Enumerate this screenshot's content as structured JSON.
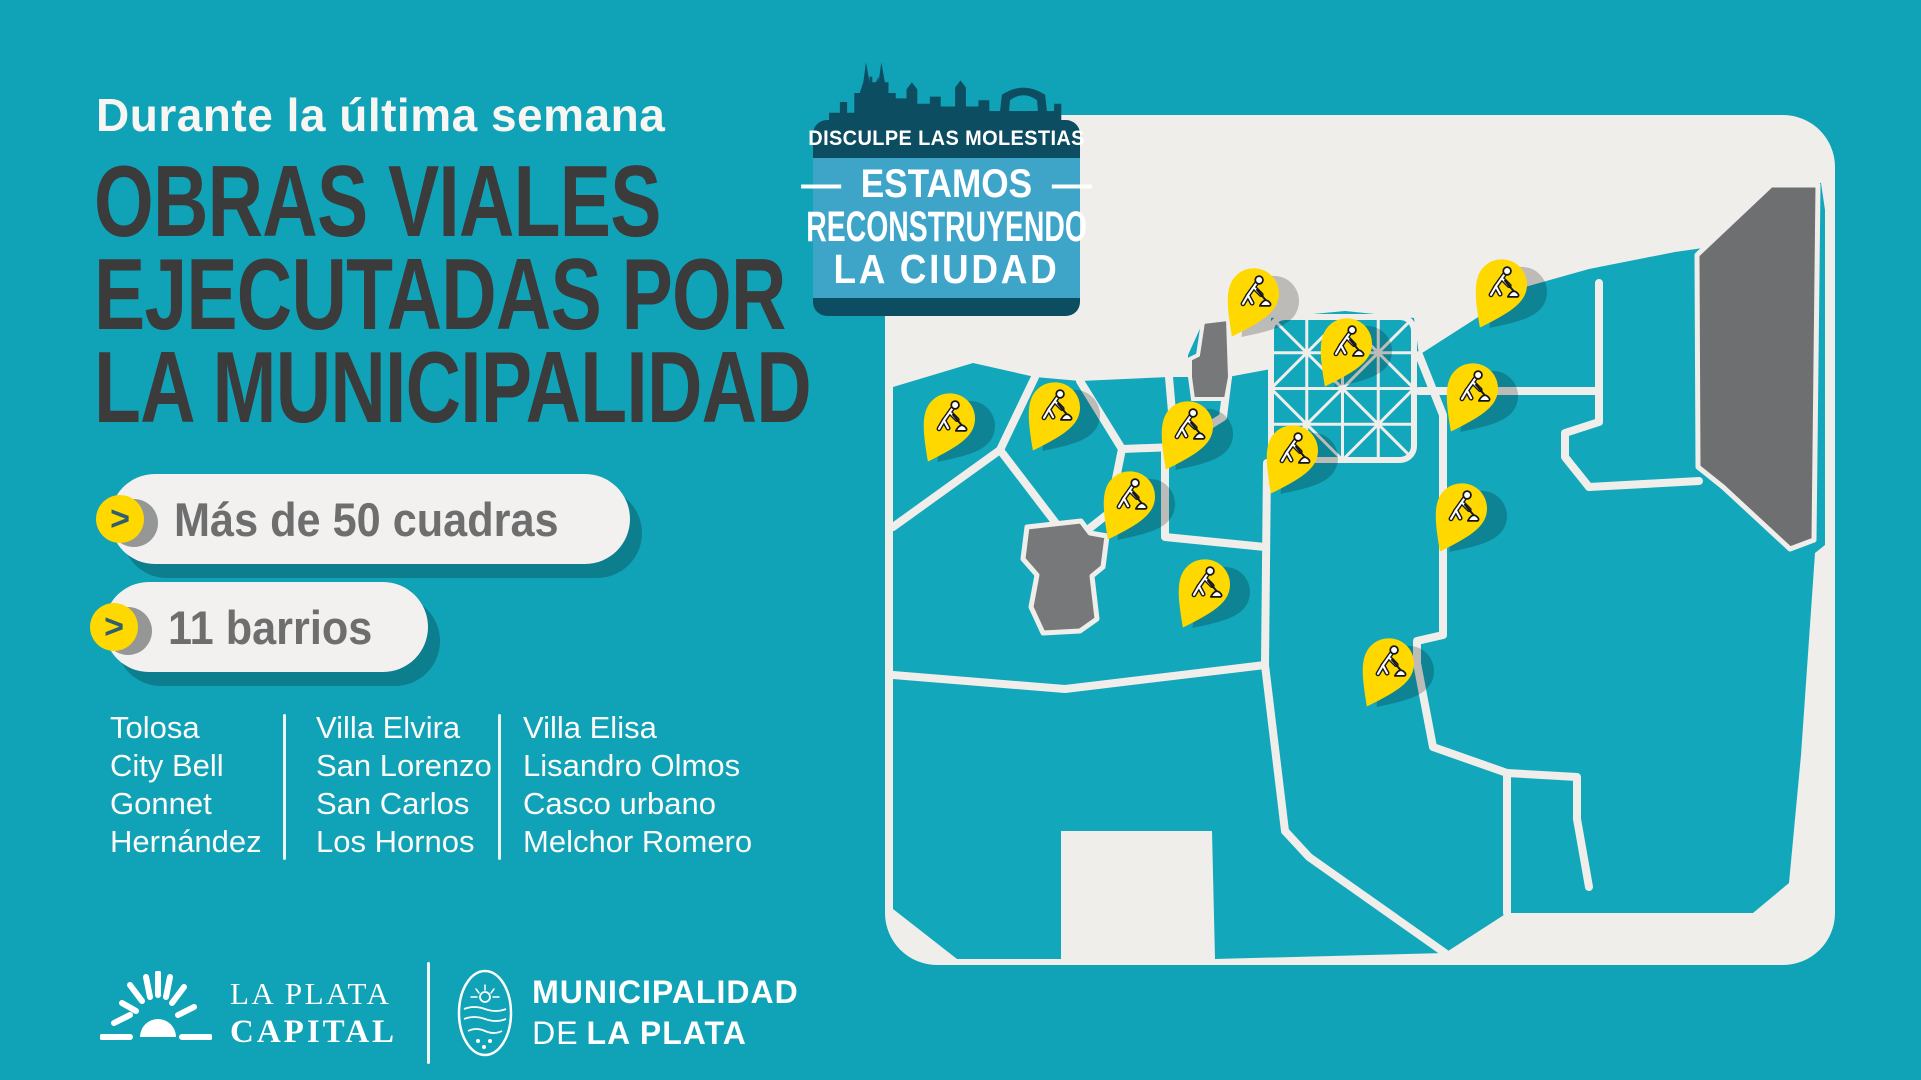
{
  "header": {
    "kicker": "Durante la última semana",
    "title_lines": [
      "OBRAS VIALES",
      "EJECUTADAS POR",
      "LA MUNICIPALIDAD"
    ]
  },
  "stats": [
    {
      "label": "Más de 50 cuadras"
    },
    {
      "label": "11 barrios"
    }
  ],
  "stats_chevron": ">",
  "neighborhoods": {
    "columns": [
      [
        "Tolosa",
        "City Bell",
        "Gonnet",
        "Hernández"
      ],
      [
        "Villa Elvira",
        "San Lorenzo",
        "San Carlos",
        "Los Hornos"
      ],
      [
        "Villa Elisa",
        "Lisandro Olmos",
        "Casco urbano",
        "Melchor Romero"
      ]
    ]
  },
  "badge": {
    "line1": "DISCULPE LAS MOLESTIAS",
    "dash": "—",
    "line2": "ESTAMOS",
    "line3": "RECONSTRUYENDO",
    "line4": "LA CIUDAD"
  },
  "footer": {
    "brand1_line1": "LA PLATA",
    "brand1_line2": "CAPITAL",
    "brand2_line1": "MUNICIPALIDAD",
    "brand2_line2_prefix": "DE",
    "brand2_line2": "LA PLATA"
  },
  "map": {
    "pin_count": 12,
    "pins": [
      {
        "x": 365,
        "y": 186
      },
      {
        "x": 458,
        "y": 236
      },
      {
        "x": 613,
        "y": 177
      },
      {
        "x": 584,
        "y": 281
      },
      {
        "x": 61,
        "y": 311
      },
      {
        "x": 166,
        "y": 300
      },
      {
        "x": 299,
        "y": 319
      },
      {
        "x": 404,
        "y": 343
      },
      {
        "x": 241,
        "y": 389
      },
      {
        "x": 573,
        "y": 401
      },
      {
        "x": 316,
        "y": 477
      },
      {
        "x": 500,
        "y": 556
      }
    ]
  },
  "colors": {
    "background_teal": "#10A2B7",
    "title_dark": "#3B3B3B",
    "pill_background": "#F2F1EF",
    "pill_text": "#6E6E6E",
    "accent_yellow": "#FFD800",
    "badge_dark_teal": "#0C4D62",
    "badge_light_blue": "#3FA5C8",
    "map_panel": "#EFEEEA",
    "map_region_teal": "#13A7BC",
    "map_region_gray": "#707175",
    "text_white": "#FFFFFF"
  }
}
